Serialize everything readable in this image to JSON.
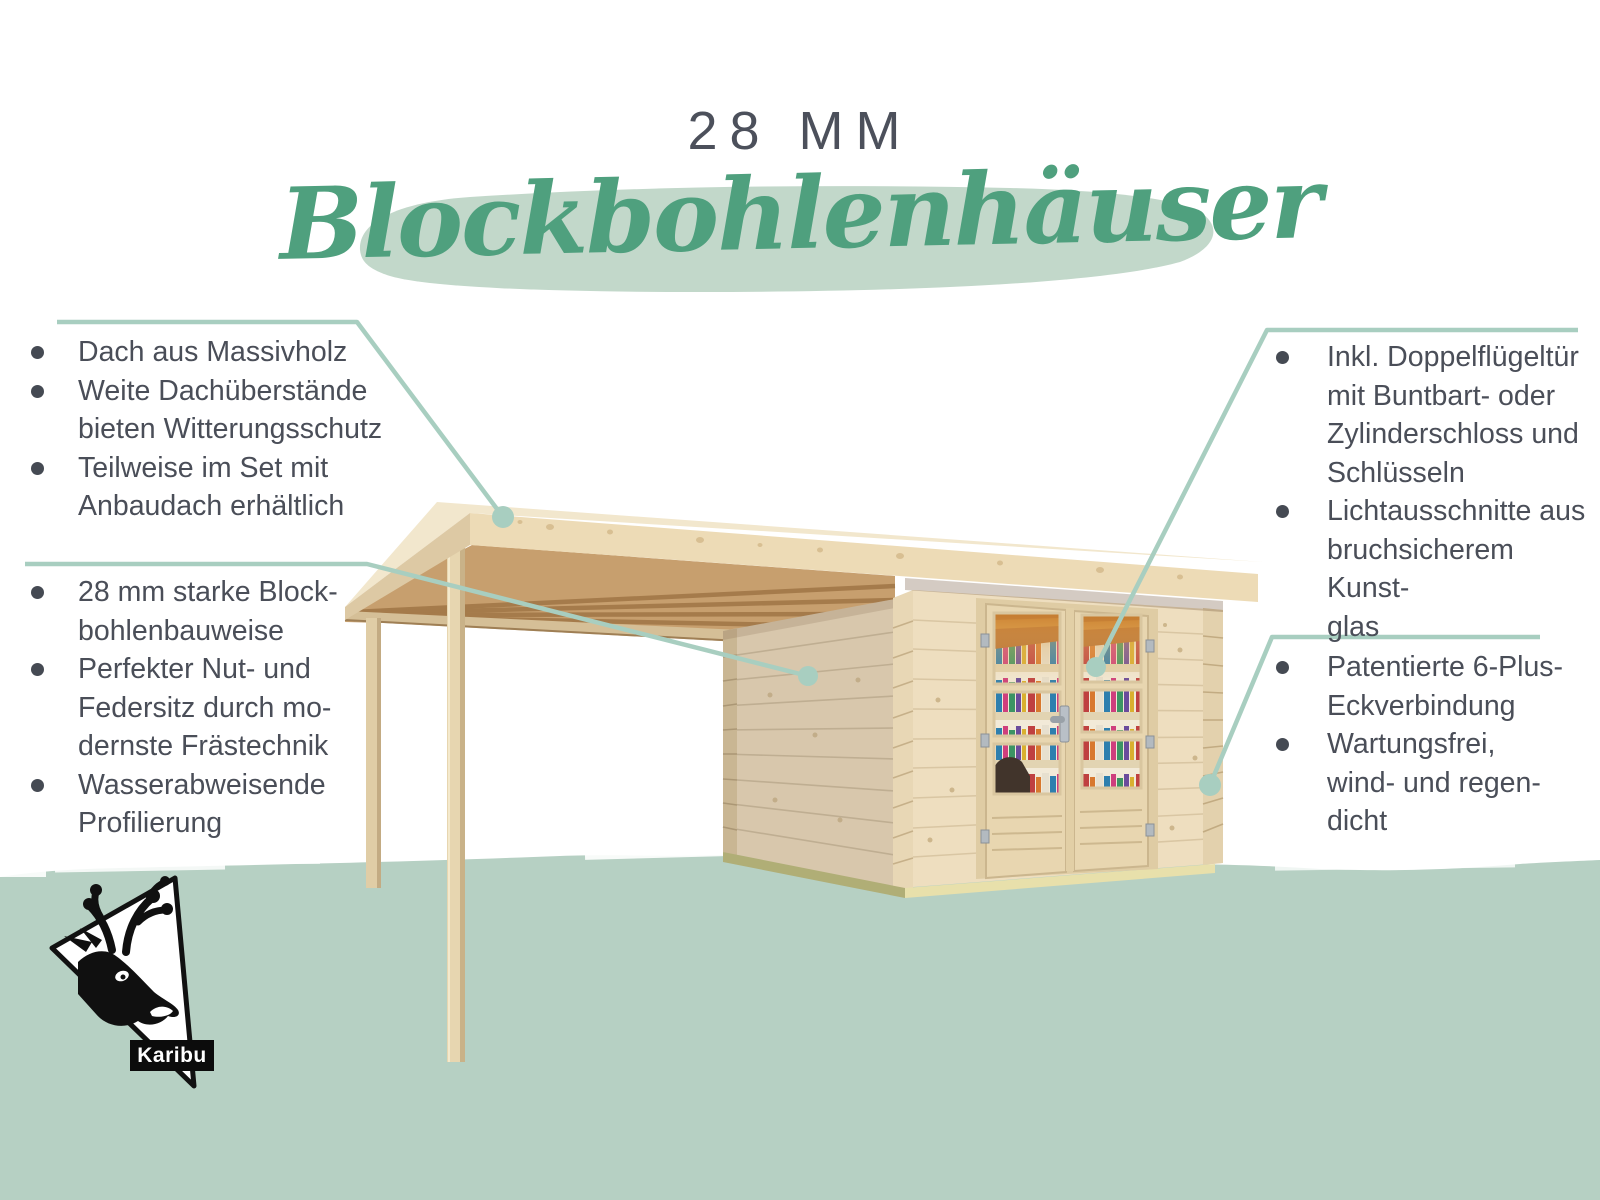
{
  "header": {
    "size_label": "28 MM",
    "title": "Blockbohlenhäuser"
  },
  "features": {
    "left_top": {
      "items": [
        {
          "text": "Dach aus Massivholz"
        },
        {
          "text": "Weite Dachüberstände\nbieten Witterungsschutz"
        },
        {
          "text": "Teilweise im Set mit\nAnbaudach erhältlich"
        }
      ]
    },
    "left_bottom": {
      "items": [
        {
          "text": "28 mm starke Block-\nbohlenbauweise"
        },
        {
          "text": "Perfekter Nut- und\nFedersitz durch mo-\ndernste Frästechnik"
        },
        {
          "text": "Wasserabweisende\nProfilierung"
        }
      ]
    },
    "right_top": {
      "items": [
        {
          "text": "Inkl. Doppelflügeltür\nmit Buntbart- oder\nZylinderschloss und\nSchlüsseln"
        },
        {
          "text": "Lichtausschnitte aus\nbruchsicherem Kunst-\nglas"
        }
      ]
    },
    "right_bottom": {
      "items": [
        {
          "text": "Patentierte 6-Plus-\nEckverbindung"
        },
        {
          "text": "Wartungsfrei,\nwind- und regen-\ndicht"
        }
      ]
    }
  },
  "logo": {
    "brand": "Karibu"
  },
  "colors": {
    "accent_green": "#4fa07e",
    "brush_green": "#c2d8ca",
    "band_green": "#b6d0c3",
    "leader_green": "#a8cec0",
    "text_dark": "#4a4e58"
  }
}
